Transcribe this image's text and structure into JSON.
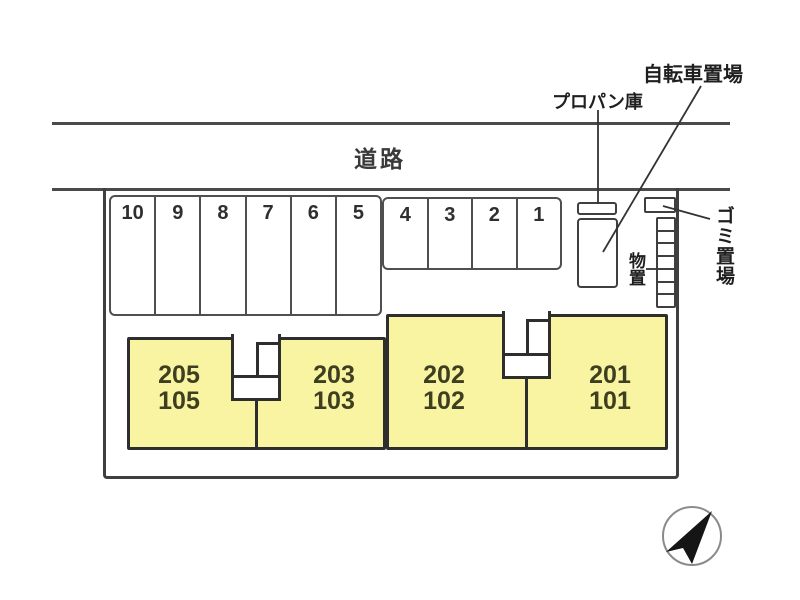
{
  "road": {
    "label": "道路"
  },
  "annotations": {
    "propane": "プロパン庫",
    "bicycle": "自転車置場",
    "garbage": "ゴミ置場",
    "storage": "物置"
  },
  "parking": {
    "front_row": [
      "10",
      "9",
      "8",
      "7",
      "6",
      "5"
    ],
    "side_row": [
      "4",
      "3",
      "2",
      "1"
    ]
  },
  "units": [
    {
      "upper": "205",
      "lower": "105"
    },
    {
      "upper": "203",
      "lower": "103"
    },
    {
      "upper": "202",
      "lower": "102"
    },
    {
      "upper": "201",
      "lower": "101"
    }
  ],
  "colors": {
    "unit_fill": "#f8f4a1",
    "unit_border": "#2e2e2e",
    "road_line": "#4a4a4a",
    "boundary": "#3f3f3f",
    "unit_text": "#3e3e20",
    "label_text": "#1f1f1f",
    "compass_ring": "#8a8a8a",
    "compass_needle": "#151515"
  }
}
